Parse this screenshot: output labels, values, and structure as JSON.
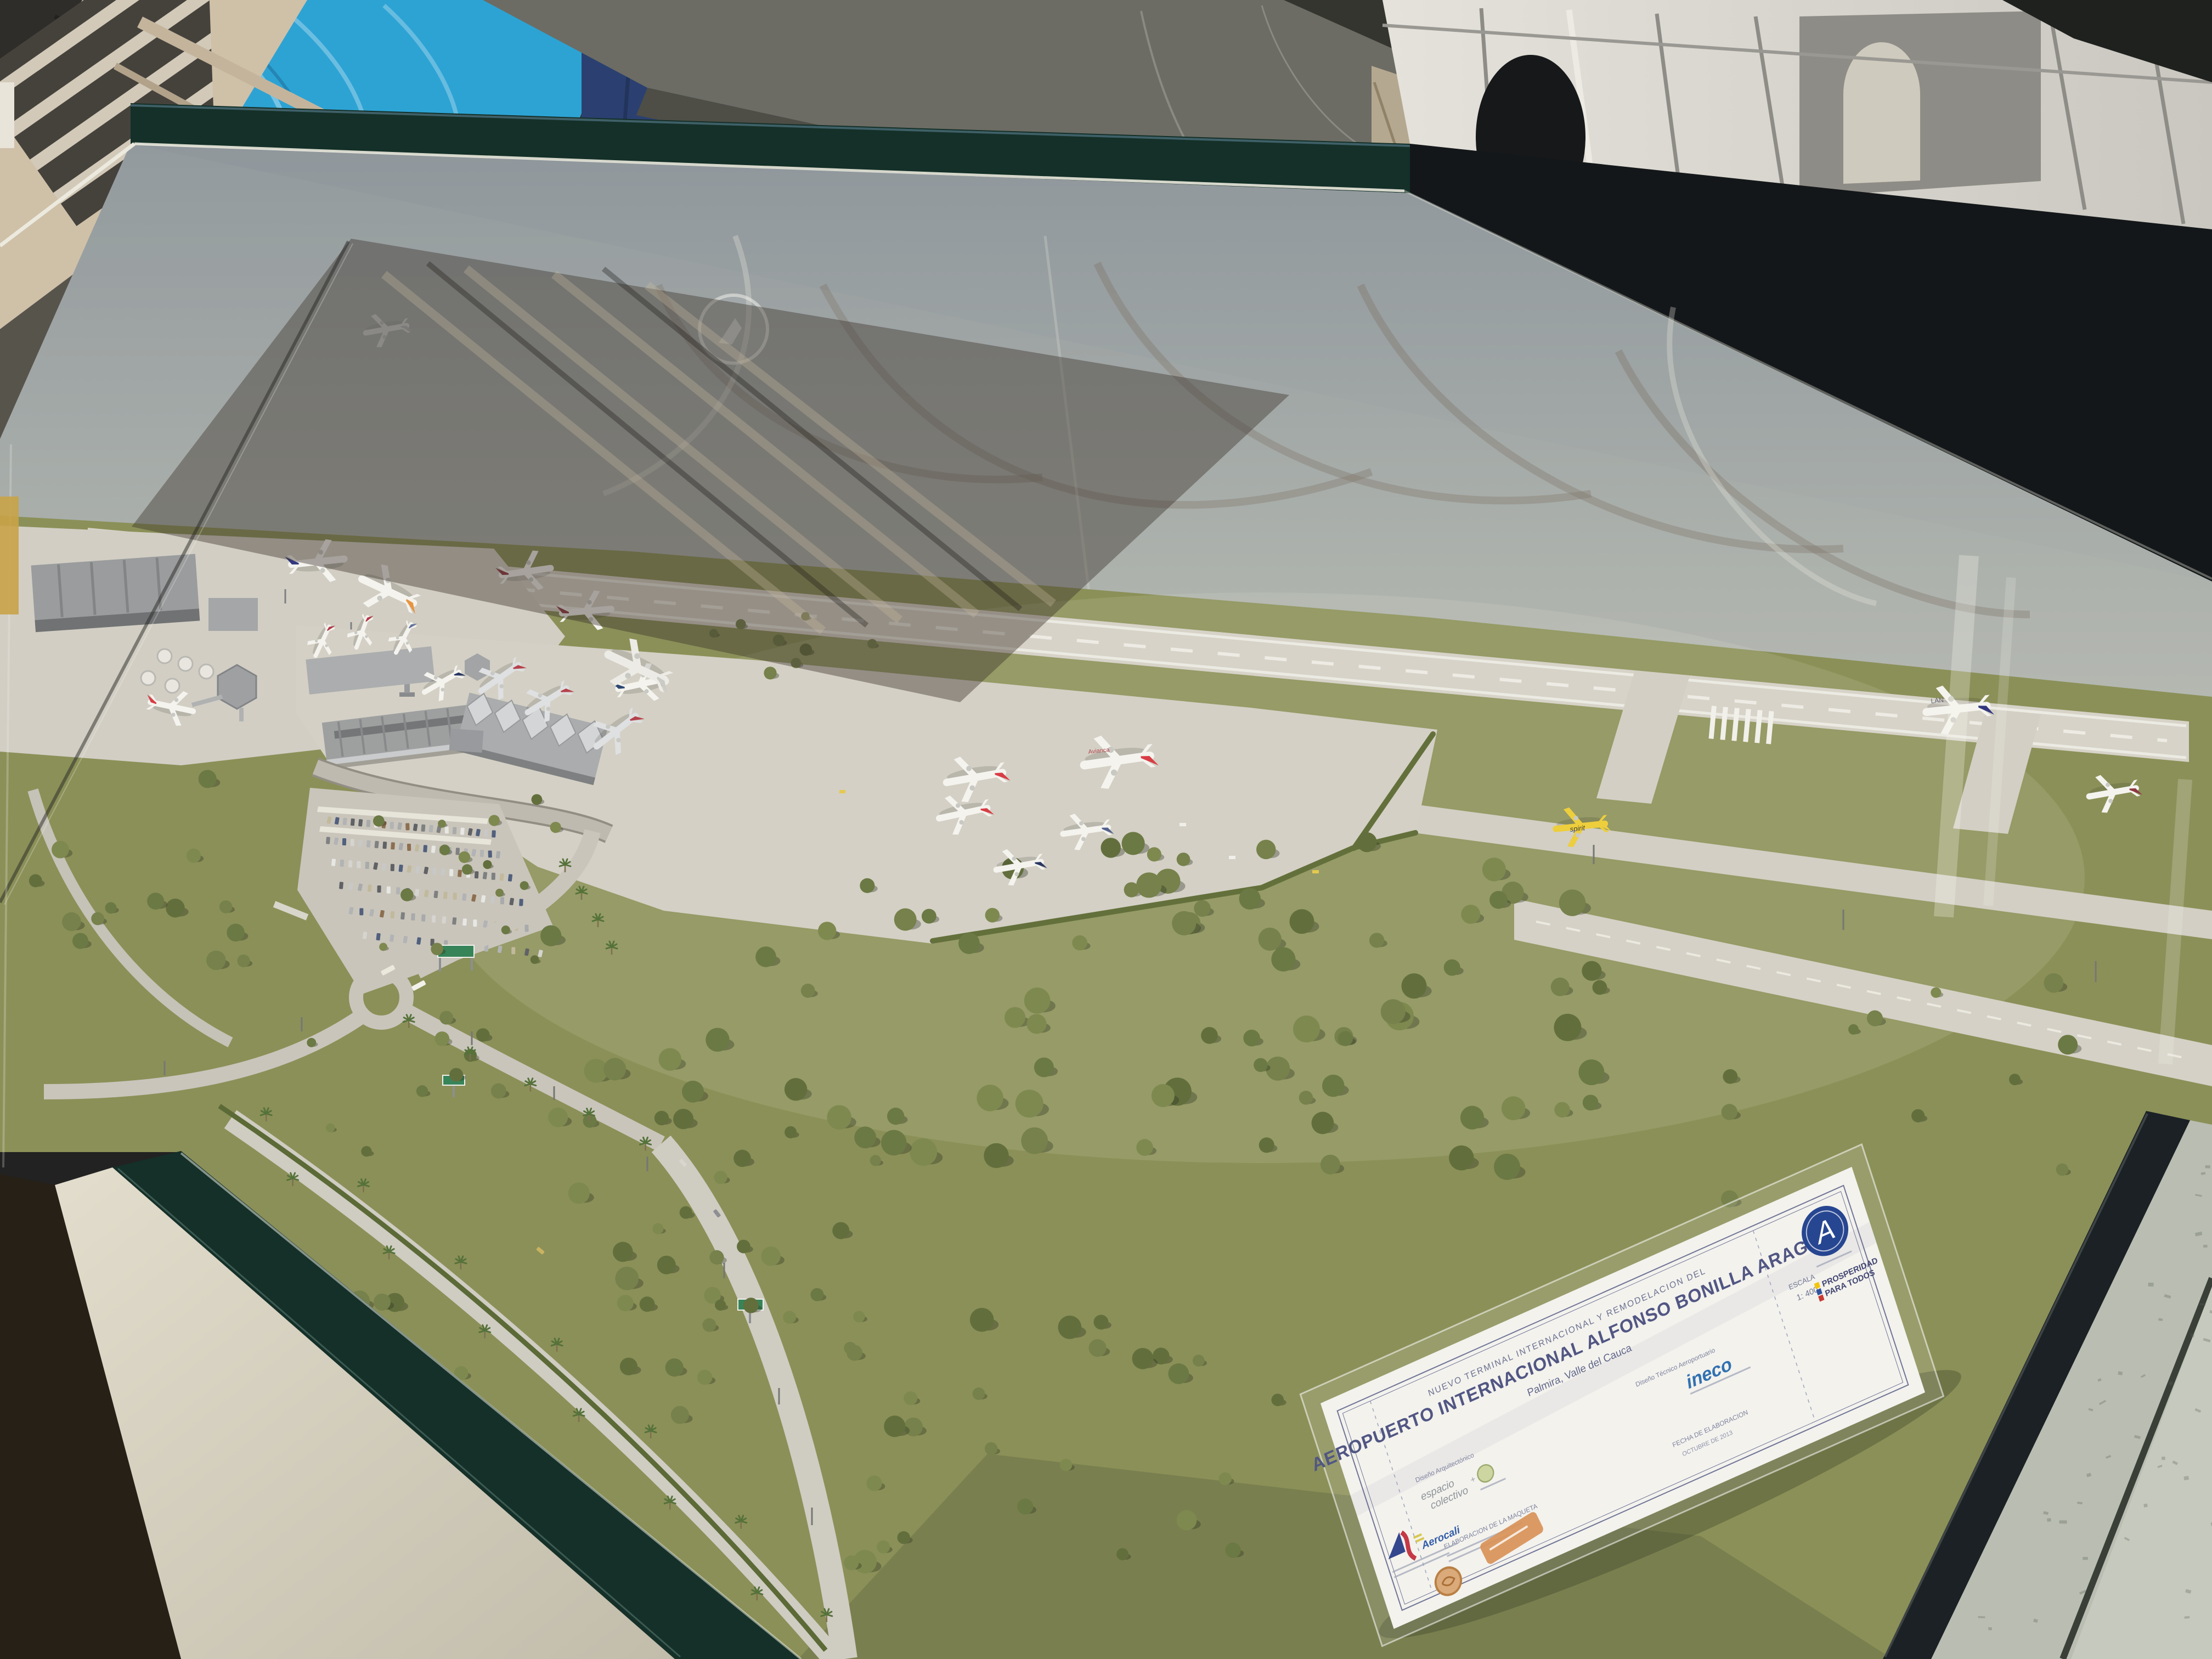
{
  "placard": {
    "heading_small": "NUEVO TERMINAL INTERNACIONAL Y REMODELACION DEL",
    "title": "AEROPUERTO INTERNACIONAL ALFONSO BONILLA ARAGON",
    "subtitle": "Palmira, Valle del Cauca",
    "arch_label": "Diseño Arquitectónico",
    "arch_value_line1": "espacio",
    "arch_value_line2": "colectivo",
    "plus": "+",
    "tech_label": "Diseño Técnico Aeroportuario",
    "tech_value": "ineco",
    "scale_label": "ESCALA",
    "scale_value": "1: 400",
    "date_label": "FECHA DE ELABORACION",
    "date_value": "OCTUBRE DE 2013",
    "maker_label": "ELABORACION DE LA MAQUETA",
    "agency_initial": "A",
    "slogan_line1": "PROSPERIDAD",
    "slogan_line2": "PARA TODOS",
    "operator": "Aerocali"
  },
  "model": {
    "plane_labels": {
      "spirit": "spirit",
      "lan": "LAN",
      "avianca": "Avianca"
    },
    "airline_liveries": [
      "Avianca",
      "LAN",
      "Copa",
      "American",
      "Spirit",
      "LAN Cargo",
      "orange-tail cargo",
      "maroon-tail cargo"
    ]
  },
  "colors": {
    "avianca": "#d8353f",
    "lan": "#2a2f7c",
    "copa": "#1f2f5e",
    "spirit": "#efce35",
    "sign_green": "#2f8054",
    "ineco_blue": "#2a6cb0",
    "aerocivil_navy": "#1e3f8f",
    "aerocali_blue": "#2b3f8c",
    "aerocali_red": "#c53040",
    "flag_yellow": "#f5c400",
    "flag_blue": "#2a4b9b",
    "flag_red": "#c8322b",
    "case_frame": "#143028",
    "model_green": "#878d53",
    "tarp_blue": "#2da3d4"
  }
}
